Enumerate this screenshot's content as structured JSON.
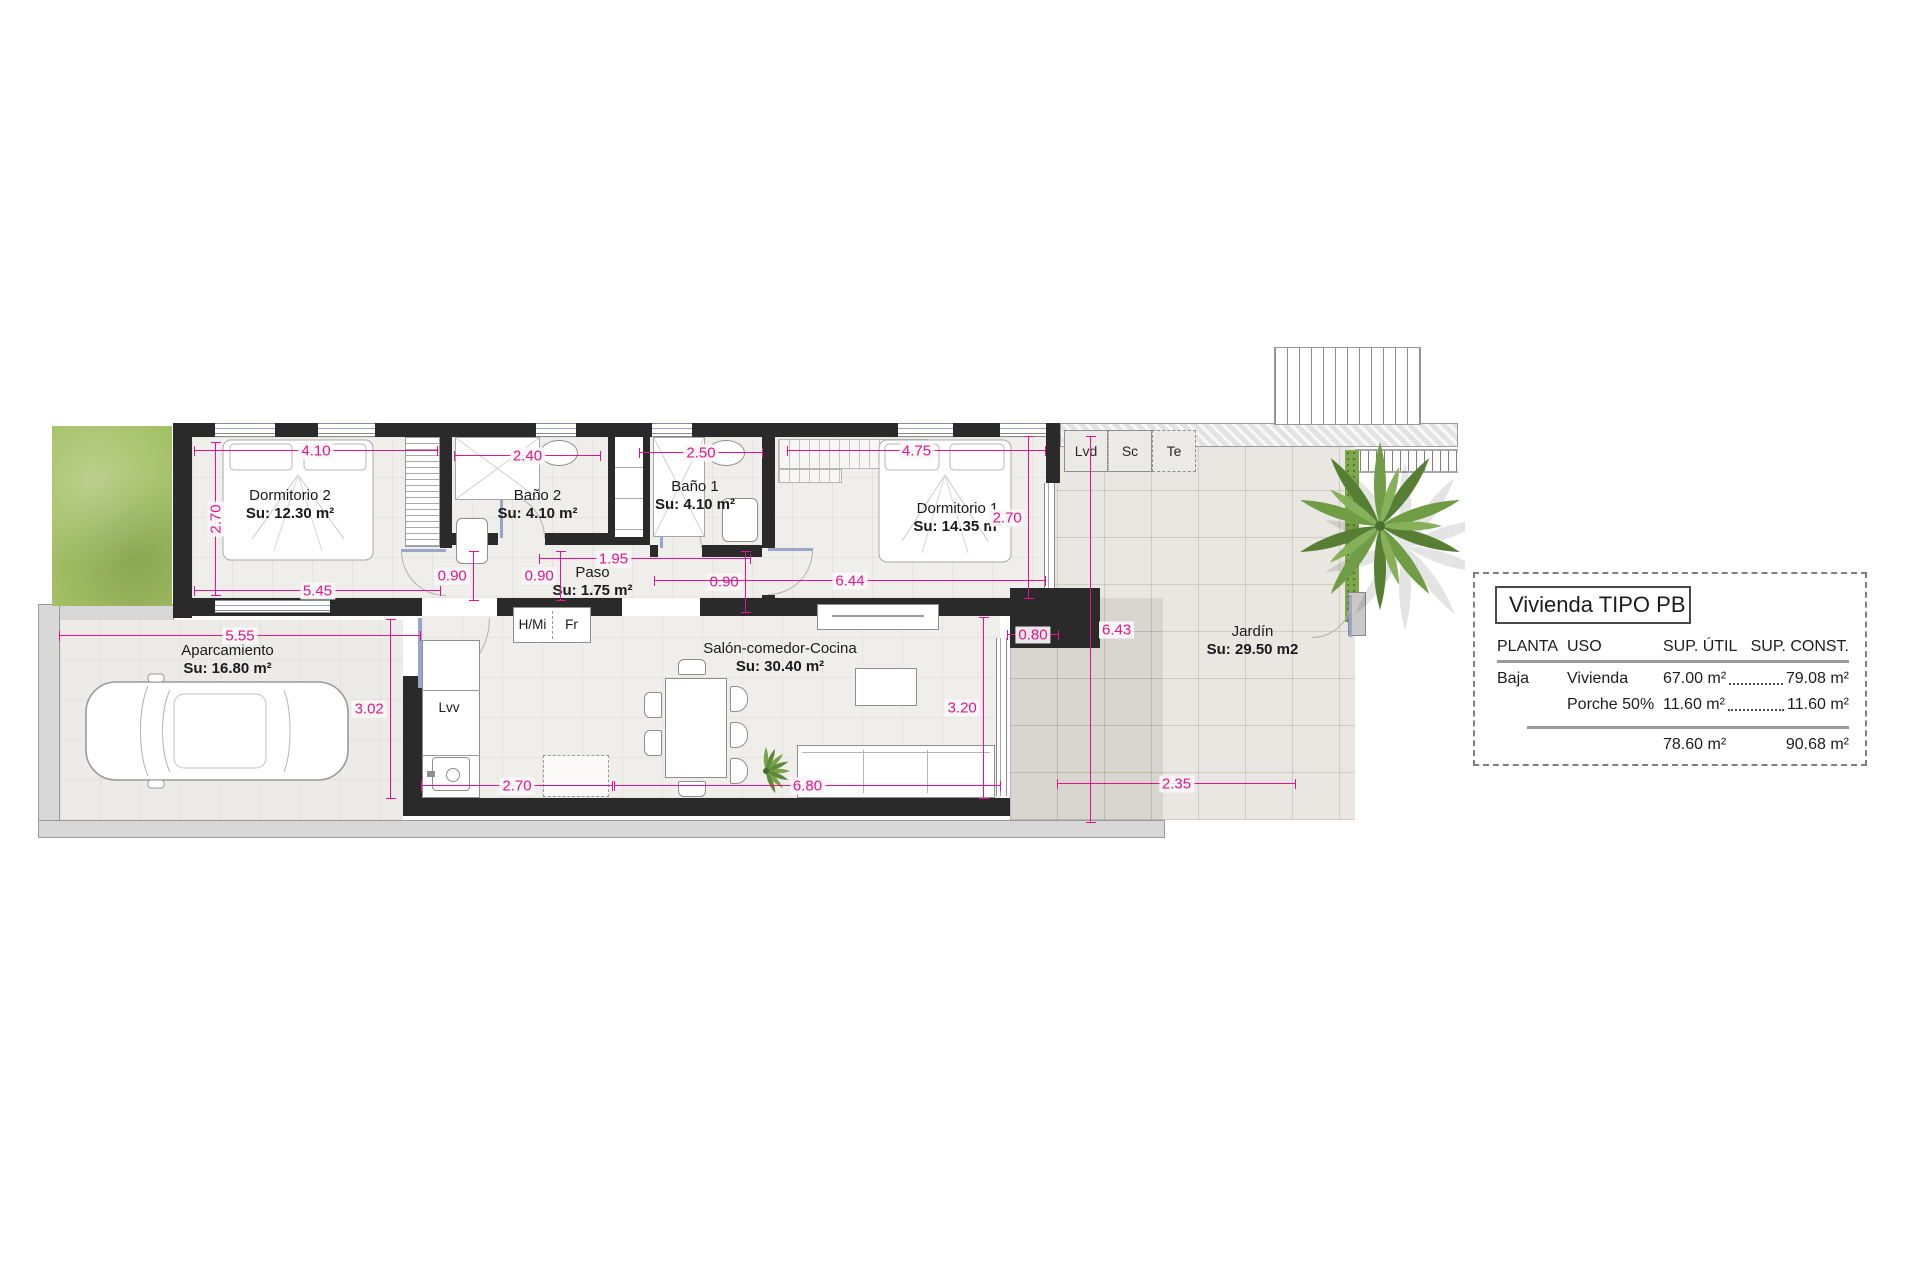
{
  "plan": {
    "rooms": {
      "dorm2": {
        "name": "Dormitorio 2",
        "su": "Su: 12.30 m²"
      },
      "bano2": {
        "name": "Baño 2",
        "su": "Su: 4.10 m²"
      },
      "bano1": {
        "name": "Baño 1",
        "su": "Su: 4.10 m²"
      },
      "dorm1": {
        "name": "Dormitorio 1",
        "su": "Su: 14.35 m²"
      },
      "paso": {
        "name": "Paso",
        "su": "Su: 1.75 m²"
      },
      "salon": {
        "name": "Salón-comedor-Cocina",
        "su": "Su: 30.40 m²"
      },
      "aparcamiento": {
        "name": "Aparcamiento",
        "su": "Su: 16.80 m²"
      },
      "jardin": {
        "name": "Jardín",
        "su": "Su: 29.50 m2"
      }
    },
    "fixtures": {
      "lvd": "Lvd",
      "sc": "Sc",
      "te": "Te",
      "hmi": "H/Mi",
      "fr": "Fr",
      "lvv": "Lvv"
    },
    "dims": [
      "4.10",
      "2.70",
      "2.40",
      "2.50",
      "4.75",
      "2.70",
      "5.45",
      "0.90",
      "0.90",
      "1.95",
      "0.90",
      "6.44",
      "5.55",
      "3.02",
      "2.70",
      "6.80",
      "3.20",
      "0.80",
      "6.43",
      "2.35"
    ]
  },
  "legend": {
    "title": "Vivienda TIPO PB",
    "headers": {
      "planta": "PLANTA",
      "uso": "USO",
      "util": "SUP. ÚTIL",
      "sup_const": "SUP. CONST."
    },
    "rows": [
      {
        "planta": "Baja",
        "uso": "Vivienda",
        "util": "67.00 m²",
        "sup_const": "79.08 m²"
      },
      {
        "planta": "",
        "uso": "Porche 50%",
        "util": "11.60 m²",
        "sup_const": "11.60 m²"
      }
    ],
    "totals": {
      "util": "78.60 m²",
      "sup_const": "90.68 m²"
    }
  },
  "colors": {
    "dimension": "#e6138f",
    "wall": "#2a2a2a",
    "grass": "#a3c065",
    "porch": "#d9d6d0",
    "sidewalk": "#d8d8d8"
  }
}
